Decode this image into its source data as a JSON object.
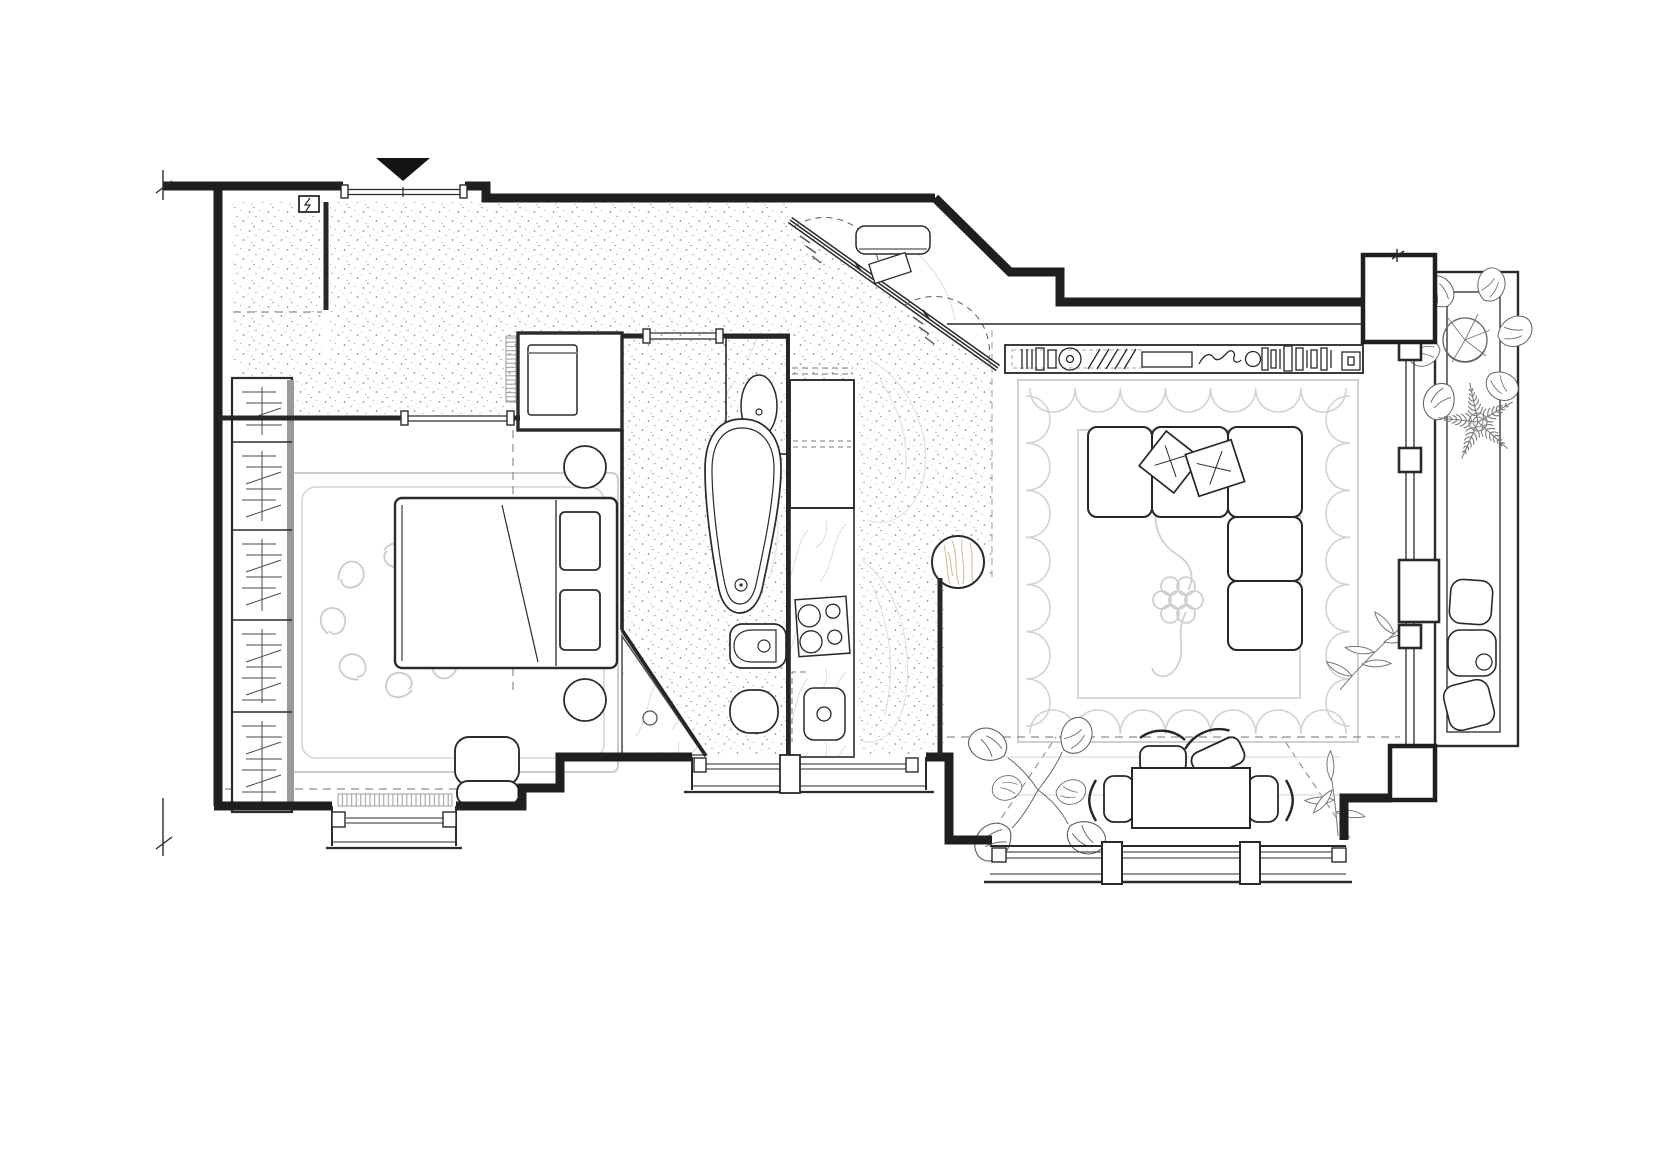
{
  "document": {
    "kind": "Architectural floor plan of a one-bedroom apartment, top-down black line drawing on white",
    "orientation": "entrance at top marked with solid black triangle",
    "background": "#ffffff",
    "ink": "#2a2a2a"
  },
  "palette": {
    "wall": "#1f1f1f",
    "thin_line": "#2a2a2a",
    "light_gray": "#cccccc",
    "stipple_dot": "#8c8c8c",
    "marble_vein": "#dedede",
    "wood_grain": "#d2c79f",
    "entrance_marker": "#141414"
  },
  "legend": {
    "rooms": {
      "entry": "entry hall with speckled stone floor",
      "closet": "entry coat closet",
      "bedroom": "bedroom",
      "bathroom": "bathroom",
      "laundry": "laundry / washing machine closet",
      "kitchen": "kitchenette counter strip",
      "corridor": "kitchen corridor with speckled floor",
      "living": "living room",
      "dining": "dining area by the window",
      "balcony": "glazed balcony with plants"
    }
  },
  "fixtures": {
    "entrance": "entrance door with black triangle direction marker",
    "electrical_panel": "small electrical panel with lightning glyph",
    "sliding_wardrobe": "diagonal sliding-door wardrobe with dashed swing arcs",
    "bench": "bench inside entry niche",
    "wardrobe": "built-in wardrobe with clothes-on-rail symbols",
    "bed": "double bed with two pillows and folded blanket line",
    "nightstands": "two round bedside tables",
    "bedroom_rug": "bedroom rug with curl medallion",
    "armchair": "small armchair at bedroom window",
    "radiator_bedroom": "radiator under bedroom window",
    "radiator_hall": "wall radiator at laundry closet",
    "washer": "washing machine",
    "basin": "oval washbasin on marble vanity",
    "bathtub": "freestanding teardrop bathtub",
    "bidet": "bidet",
    "toilet": "toilet",
    "shower": "corner shower with diagonal screen and floor drain",
    "fridge": "tall kitchen unit / fridge",
    "stove": "four-burner hob",
    "kitchen_sink": "kitchen sink with drain",
    "side_table": "round wooden side table",
    "tv_console": "long media console with books, records and decor",
    "sofa": "L-shaped sectional sofa with two throw pillows",
    "living_rug": "large rug with scalloped leaf border and flower motif",
    "dining_table": "rectangular dining table with four curved-back chairs",
    "windows": "window bays with sills and mullions",
    "poufs": "three floor poufs on the balcony",
    "plants": "monstera, fern star and leafy branch plants"
  }
}
